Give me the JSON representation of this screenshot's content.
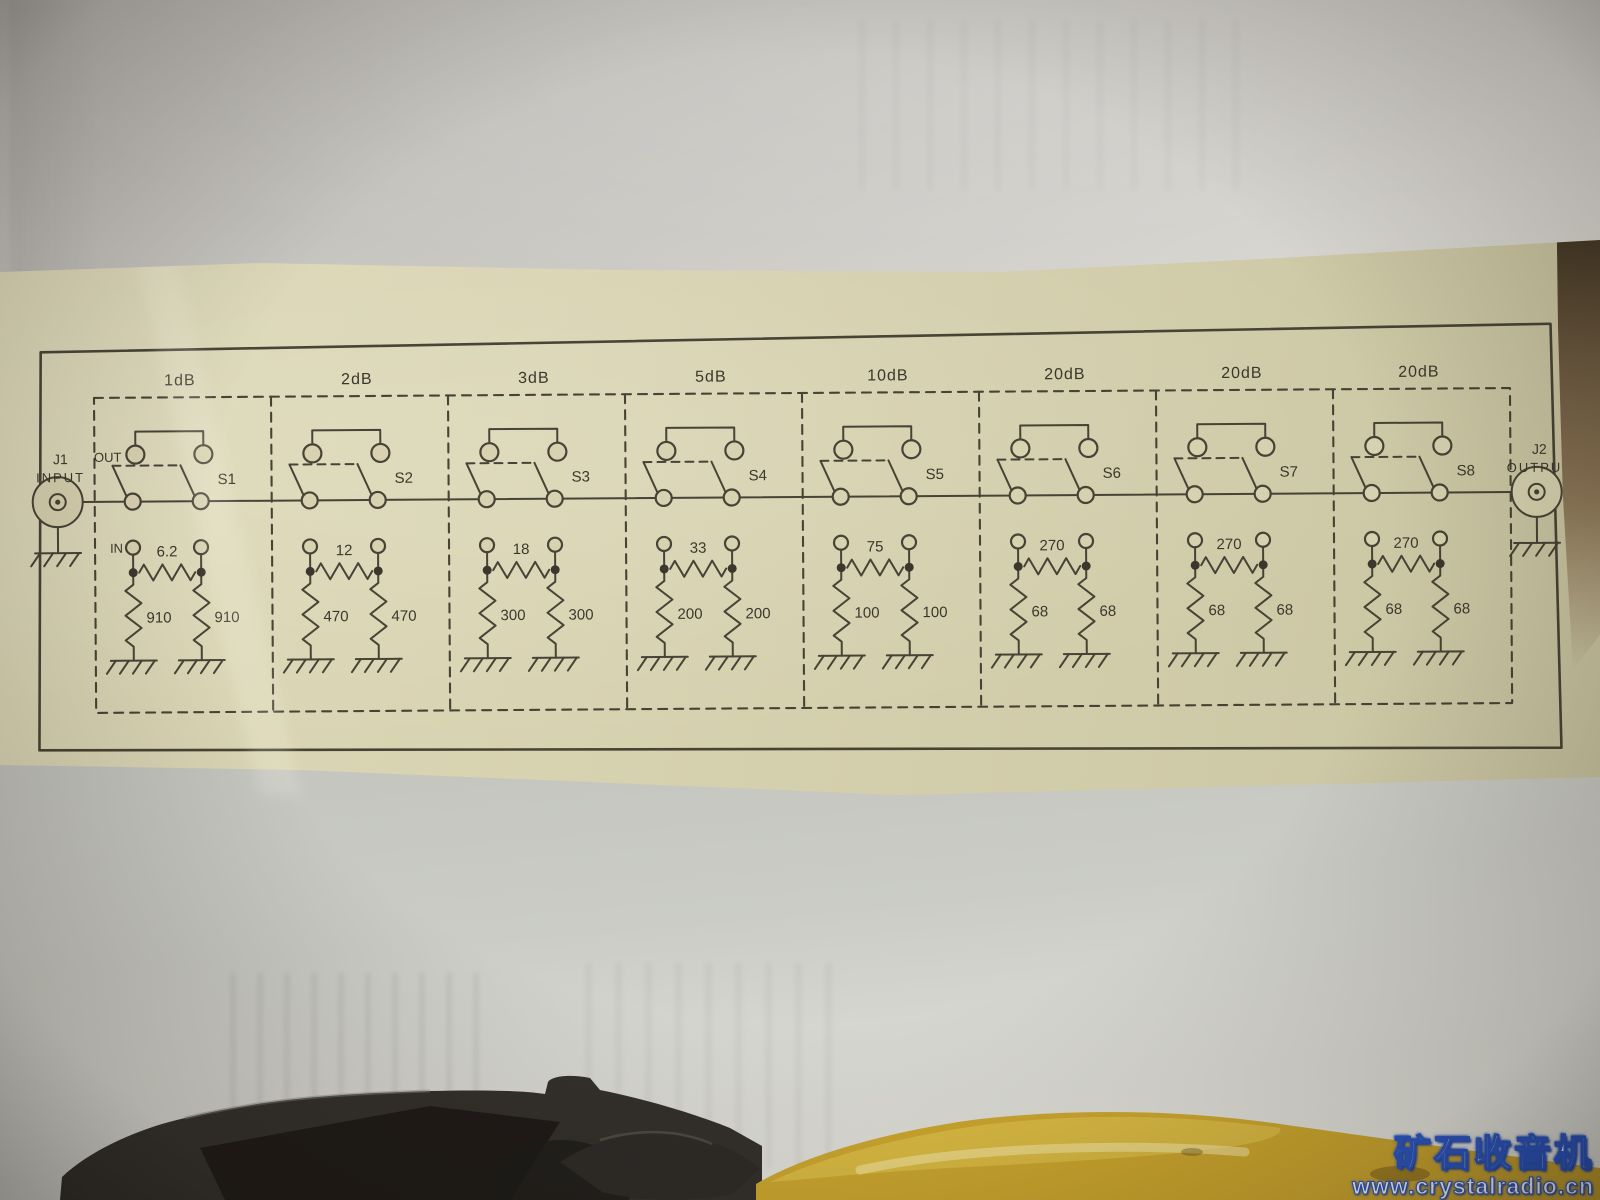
{
  "watermark": {
    "title": "矿石收音机",
    "url": "www.crystalradio.cn"
  },
  "colors": {
    "ink": "#3b372c",
    "paper_cream": "#d7d2b0",
    "watermark_blue": "#2a57c8",
    "tool_yellow": "#cfa92f"
  },
  "schematic": {
    "input": {
      "ref": "J1",
      "label": "INPUT"
    },
    "output": {
      "ref": "J2",
      "label": "OUTPUT"
    },
    "out_label": "OUT",
    "in_label": "IN",
    "sections": [
      {
        "db": "1dB",
        "switch": "S1",
        "series": "6.2",
        "shunt_left": "910",
        "shunt_right": "910"
      },
      {
        "db": "2dB",
        "switch": "S2",
        "series": "12",
        "shunt_left": "470",
        "shunt_right": "470"
      },
      {
        "db": "3dB",
        "switch": "S3",
        "series": "18",
        "shunt_left": "300",
        "shunt_right": "300"
      },
      {
        "db": "5dB",
        "switch": "S4",
        "series": "33",
        "shunt_left": "200",
        "shunt_right": "200"
      },
      {
        "db": "10dB",
        "switch": "S5",
        "series": "75",
        "shunt_left": "100",
        "shunt_right": "100"
      },
      {
        "db": "20dB",
        "switch": "S6",
        "series": "270",
        "shunt_left": "68",
        "shunt_right": "68"
      },
      {
        "db": "20dB",
        "switch": "S7",
        "series": "270",
        "shunt_left": "68",
        "shunt_right": "68"
      },
      {
        "db": "20dB",
        "switch": "S8",
        "series": "270",
        "shunt_left": "68",
        "shunt_right": "68"
      }
    ]
  }
}
